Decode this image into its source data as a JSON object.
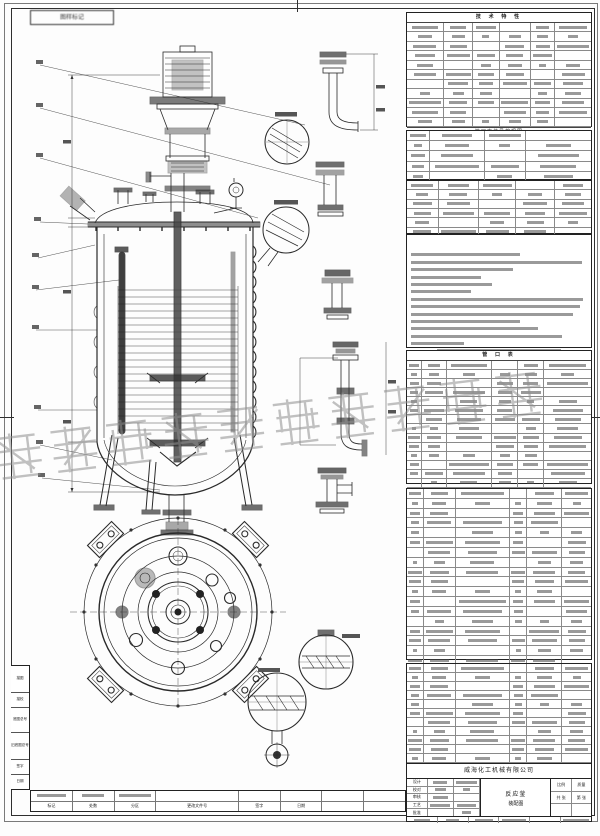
{
  "sheet": {
    "corner_label": "图样标记",
    "watermark": "威海化工机械有限公司",
    "smudge_pattern": [
      72,
      45,
      88,
      55,
      28,
      64,
      80,
      38,
      60
    ]
  },
  "right_panel": {
    "tables": [
      {
        "id": "tbl-tech",
        "title": "技 术 特 性",
        "footer": "管口方位见俯视图",
        "rows": 11,
        "cols": [
          20,
          16,
          14,
          17,
          13,
          20
        ]
      },
      {
        "id": "tbl-t2",
        "title": "",
        "footer": "",
        "rows": 5,
        "cols": [
          12,
          30,
          22,
          36
        ]
      },
      {
        "id": "tbl-t3",
        "title": "",
        "footer": "",
        "rows": 6,
        "cols": [
          17,
          22,
          20,
          21,
          20
        ]
      },
      {
        "id": "tbl-nozzle",
        "title": "管 口 表",
        "footer": "",
        "rows": 15,
        "cols": [
          8,
          13,
          25,
          14,
          14,
          26
        ]
      },
      {
        "id": "tbl-bom1",
        "title": "",
        "footer": "",
        "rows": 18,
        "cols": [
          9,
          17,
          30,
          9,
          19,
          16
        ],
        "header": [
          "序号",
          "代号",
          "名称",
          "数量",
          "材料",
          "备注"
        ]
      },
      {
        "id": "tbl-bom2",
        "title": "",
        "footer": "",
        "rows": 11,
        "cols": [
          9,
          17,
          30,
          9,
          19,
          16
        ],
        "header": [
          "序号",
          "代号",
          "名称",
          "数量",
          "材料",
          "备注"
        ]
      }
    ],
    "notes": {
      "line_widths": [
        62,
        97,
        58,
        40,
        46,
        34,
        98,
        96,
        92,
        62,
        72,
        86,
        30
      ],
      "last_line_width": 70,
      "last_line_centered": true
    }
  },
  "title_block": {
    "company": "威海化工机械有限公司",
    "product_line1": "反应釜",
    "product_line2": "装配图",
    "sign_rows": [
      "设计",
      "校对",
      "审核",
      "工艺",
      "批准"
    ],
    "info_rows": [
      [
        "比例",
        "质量"
      ],
      [
        "共 张",
        "第 张"
      ],
      [
        "",
        ""
      ]
    ]
  },
  "revision_strip": {
    "labels": [
      "标记",
      "处数",
      "分区",
      "更改文件号",
      "签字",
      "日期",
      "",
      ""
    ]
  },
  "left_strip": {
    "labels": [
      "描图",
      "描校",
      "底图总号",
      "旧底图总号",
      "签字",
      "日期"
    ]
  }
}
